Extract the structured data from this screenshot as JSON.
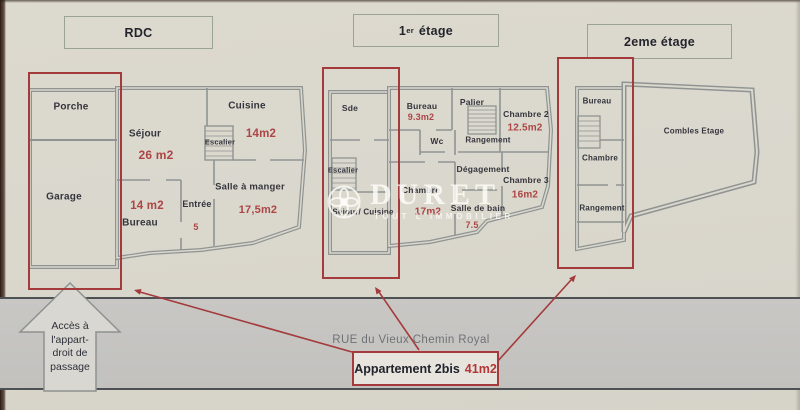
{
  "colors": {
    "paper": "#dad7cd",
    "accent_red": "#a43a3b",
    "area_text_red": "#ad4545",
    "wall_gray": "#8f9492",
    "street_band": "#c6c5c2"
  },
  "headers": {
    "rdc": "RDC",
    "etage1": {
      "prefix": "1",
      "sup": "er",
      "rest": " étage"
    },
    "etage2": "2eme étage"
  },
  "plans": {
    "rdc": {
      "rooms": {
        "porche": {
          "name": "Porche"
        },
        "sejour": {
          "name": "Séjour",
          "area": "26 m2"
        },
        "cuisine": {
          "name": "Cuisine",
          "area": "14m2"
        },
        "escalier": {
          "name": "Escalier"
        },
        "garage": {
          "name": "Garage"
        },
        "salle_a_manger": {
          "name": "Salle à manger",
          "area": "17,5m2"
        },
        "bureau": {
          "name": "Bureau",
          "area": "14 m2"
        },
        "entree": {
          "name": "Entrée",
          "area": "5"
        }
      }
    },
    "etage1": {
      "rooms": {
        "sde": {
          "name": "Sde"
        },
        "bureau": {
          "name": "Bureau",
          "area": "9.3m2"
        },
        "palier": {
          "name": "Palier"
        },
        "chambre2": {
          "name": "Chambre 2",
          "area": "12.5m2"
        },
        "wc": {
          "name": "Wc"
        },
        "rangement": {
          "name": "Rangement"
        },
        "escalier": {
          "name": "Escalier"
        },
        "degagement": {
          "name": "Dégagement"
        },
        "chambre3": {
          "name": "Chambre 3",
          "area": "16m2"
        },
        "chambre": {
          "name": "Chambre",
          "area": "17m2"
        },
        "sejour_cuisine": {
          "name": "Séjour/ Cuisine"
        },
        "salle_de_bain": {
          "name": "Salle de bain",
          "area": "7.5"
        }
      }
    },
    "etage2": {
      "rooms": {
        "bureau": {
          "name": "Bureau"
        },
        "combles": {
          "name": "Combles Etage"
        },
        "chambre": {
          "name": "Chambre"
        },
        "rangement": {
          "name": "Rangement"
        }
      }
    }
  },
  "watermark": {
    "brand": "DURET",
    "tagline": "TOUT L'IMMOBILIER"
  },
  "street": {
    "name": "RUE du Vieux Chemin Royal"
  },
  "apartment": {
    "label": "Appartement 2bis",
    "area": "41m2"
  },
  "access": {
    "line1": "Accès à",
    "line2": "l'appart-",
    "line3": "droit de",
    "line4": "passage"
  }
}
